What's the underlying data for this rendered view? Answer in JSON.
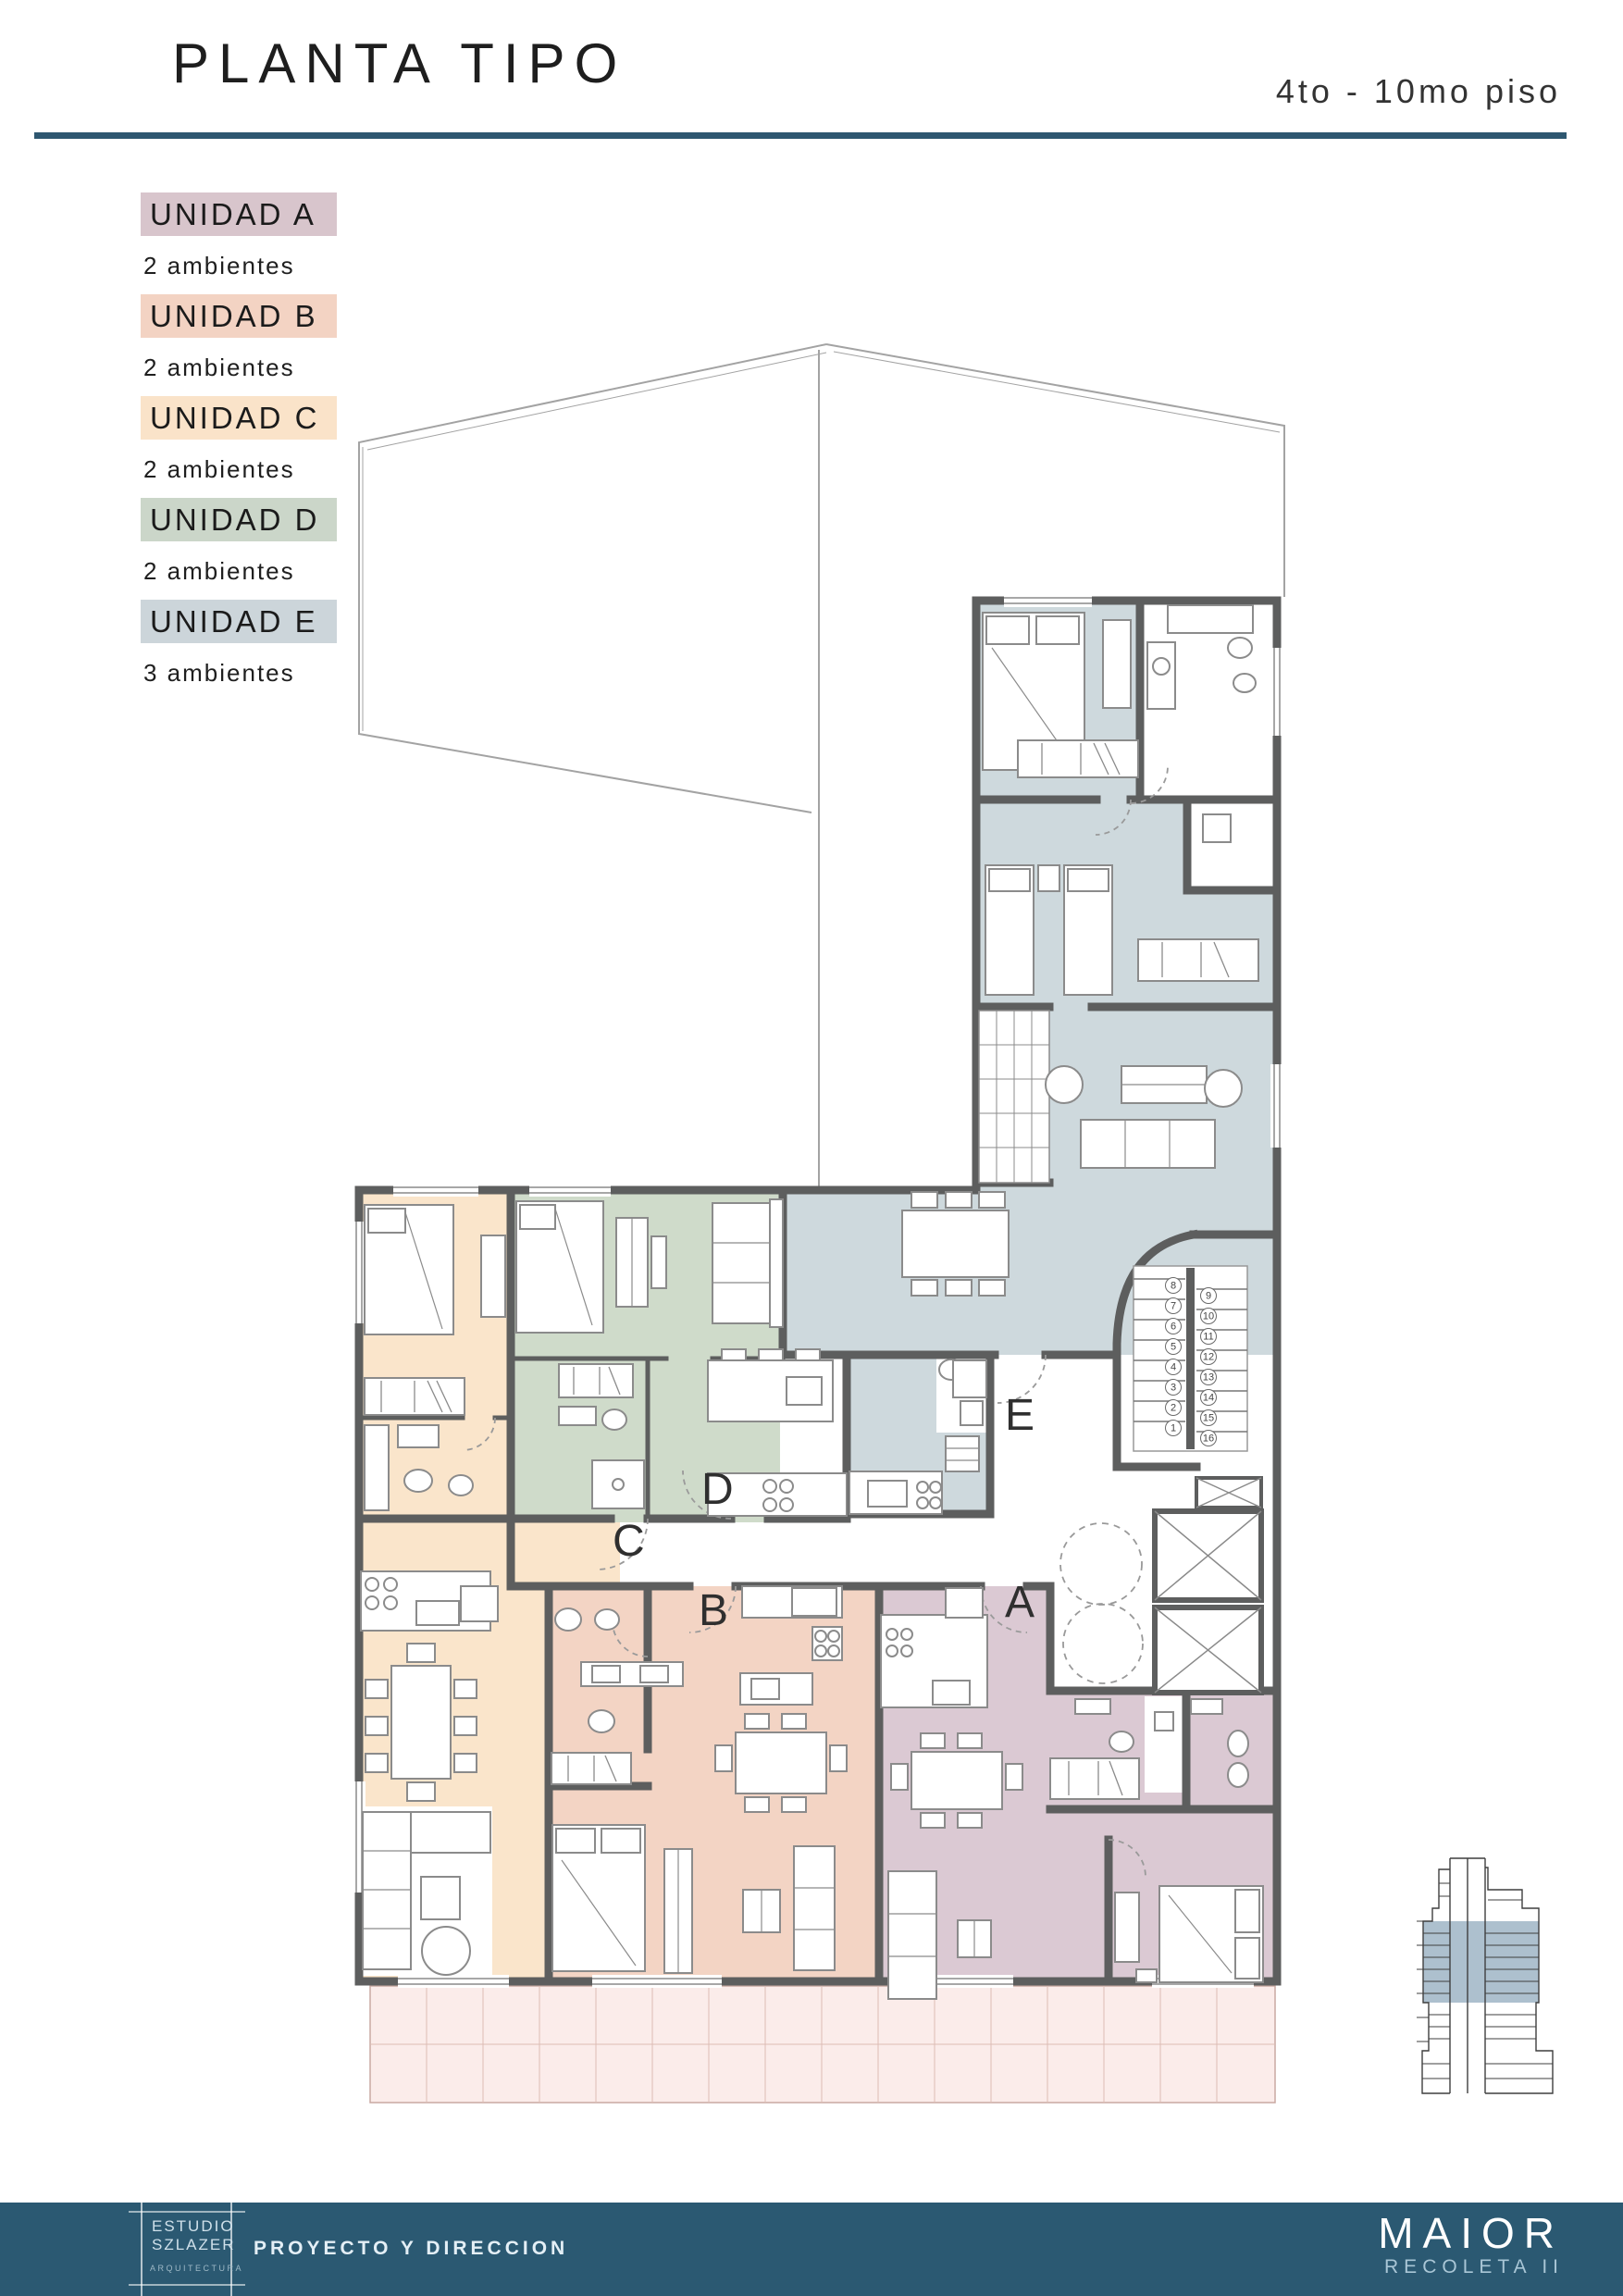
{
  "header": {
    "title": "PLANTA TIPO",
    "floors": "4to - 10mo piso"
  },
  "legend": {
    "items": [
      {
        "id": "A",
        "label": "UNIDAD A",
        "rooms": "2 ambientes",
        "color": "#d8c5cc"
      },
      {
        "id": "B",
        "label": "UNIDAD B",
        "rooms": "2 ambientes",
        "color": "#f3d3c3"
      },
      {
        "id": "C",
        "label": "UNIDAD C",
        "rooms": "2 ambientes",
        "color": "#fae3c9"
      },
      {
        "id": "D",
        "label": "UNIDAD D",
        "rooms": "2 ambientes",
        "color": "#cbd6c9"
      },
      {
        "id": "E",
        "label": "UNIDAD E",
        "rooms": "3 ambientes",
        "color": "#ccd5da"
      }
    ]
  },
  "plan": {
    "unit_labels": {
      "a": "A",
      "b": "B",
      "c": "C",
      "d": "D",
      "e": "E"
    },
    "stairs": {
      "numbers": [
        "1",
        "2",
        "3",
        "4",
        "5",
        "6",
        "7",
        "8",
        "9",
        "10",
        "11",
        "12",
        "13",
        "14",
        "15",
        "16"
      ]
    },
    "colors": {
      "unit_a": "#dbc9d3",
      "unit_b": "#f3d4c4",
      "unit_c": "#fae5cb",
      "unit_d": "#cfdbca",
      "unit_e": "#ced9dd",
      "walls": "#5d5e5e"
    }
  },
  "footer": {
    "studio_line1": "ESTUDIO",
    "studio_line2": "SZLAZER",
    "studio_sub": "ARQUITECTURA",
    "role": "PROYECTO Y DIRECCION",
    "brand": "MAIOR",
    "brand_sub": "RECOLETA II"
  },
  "building_icon": {
    "highlight_color": "#9fb5c5"
  }
}
